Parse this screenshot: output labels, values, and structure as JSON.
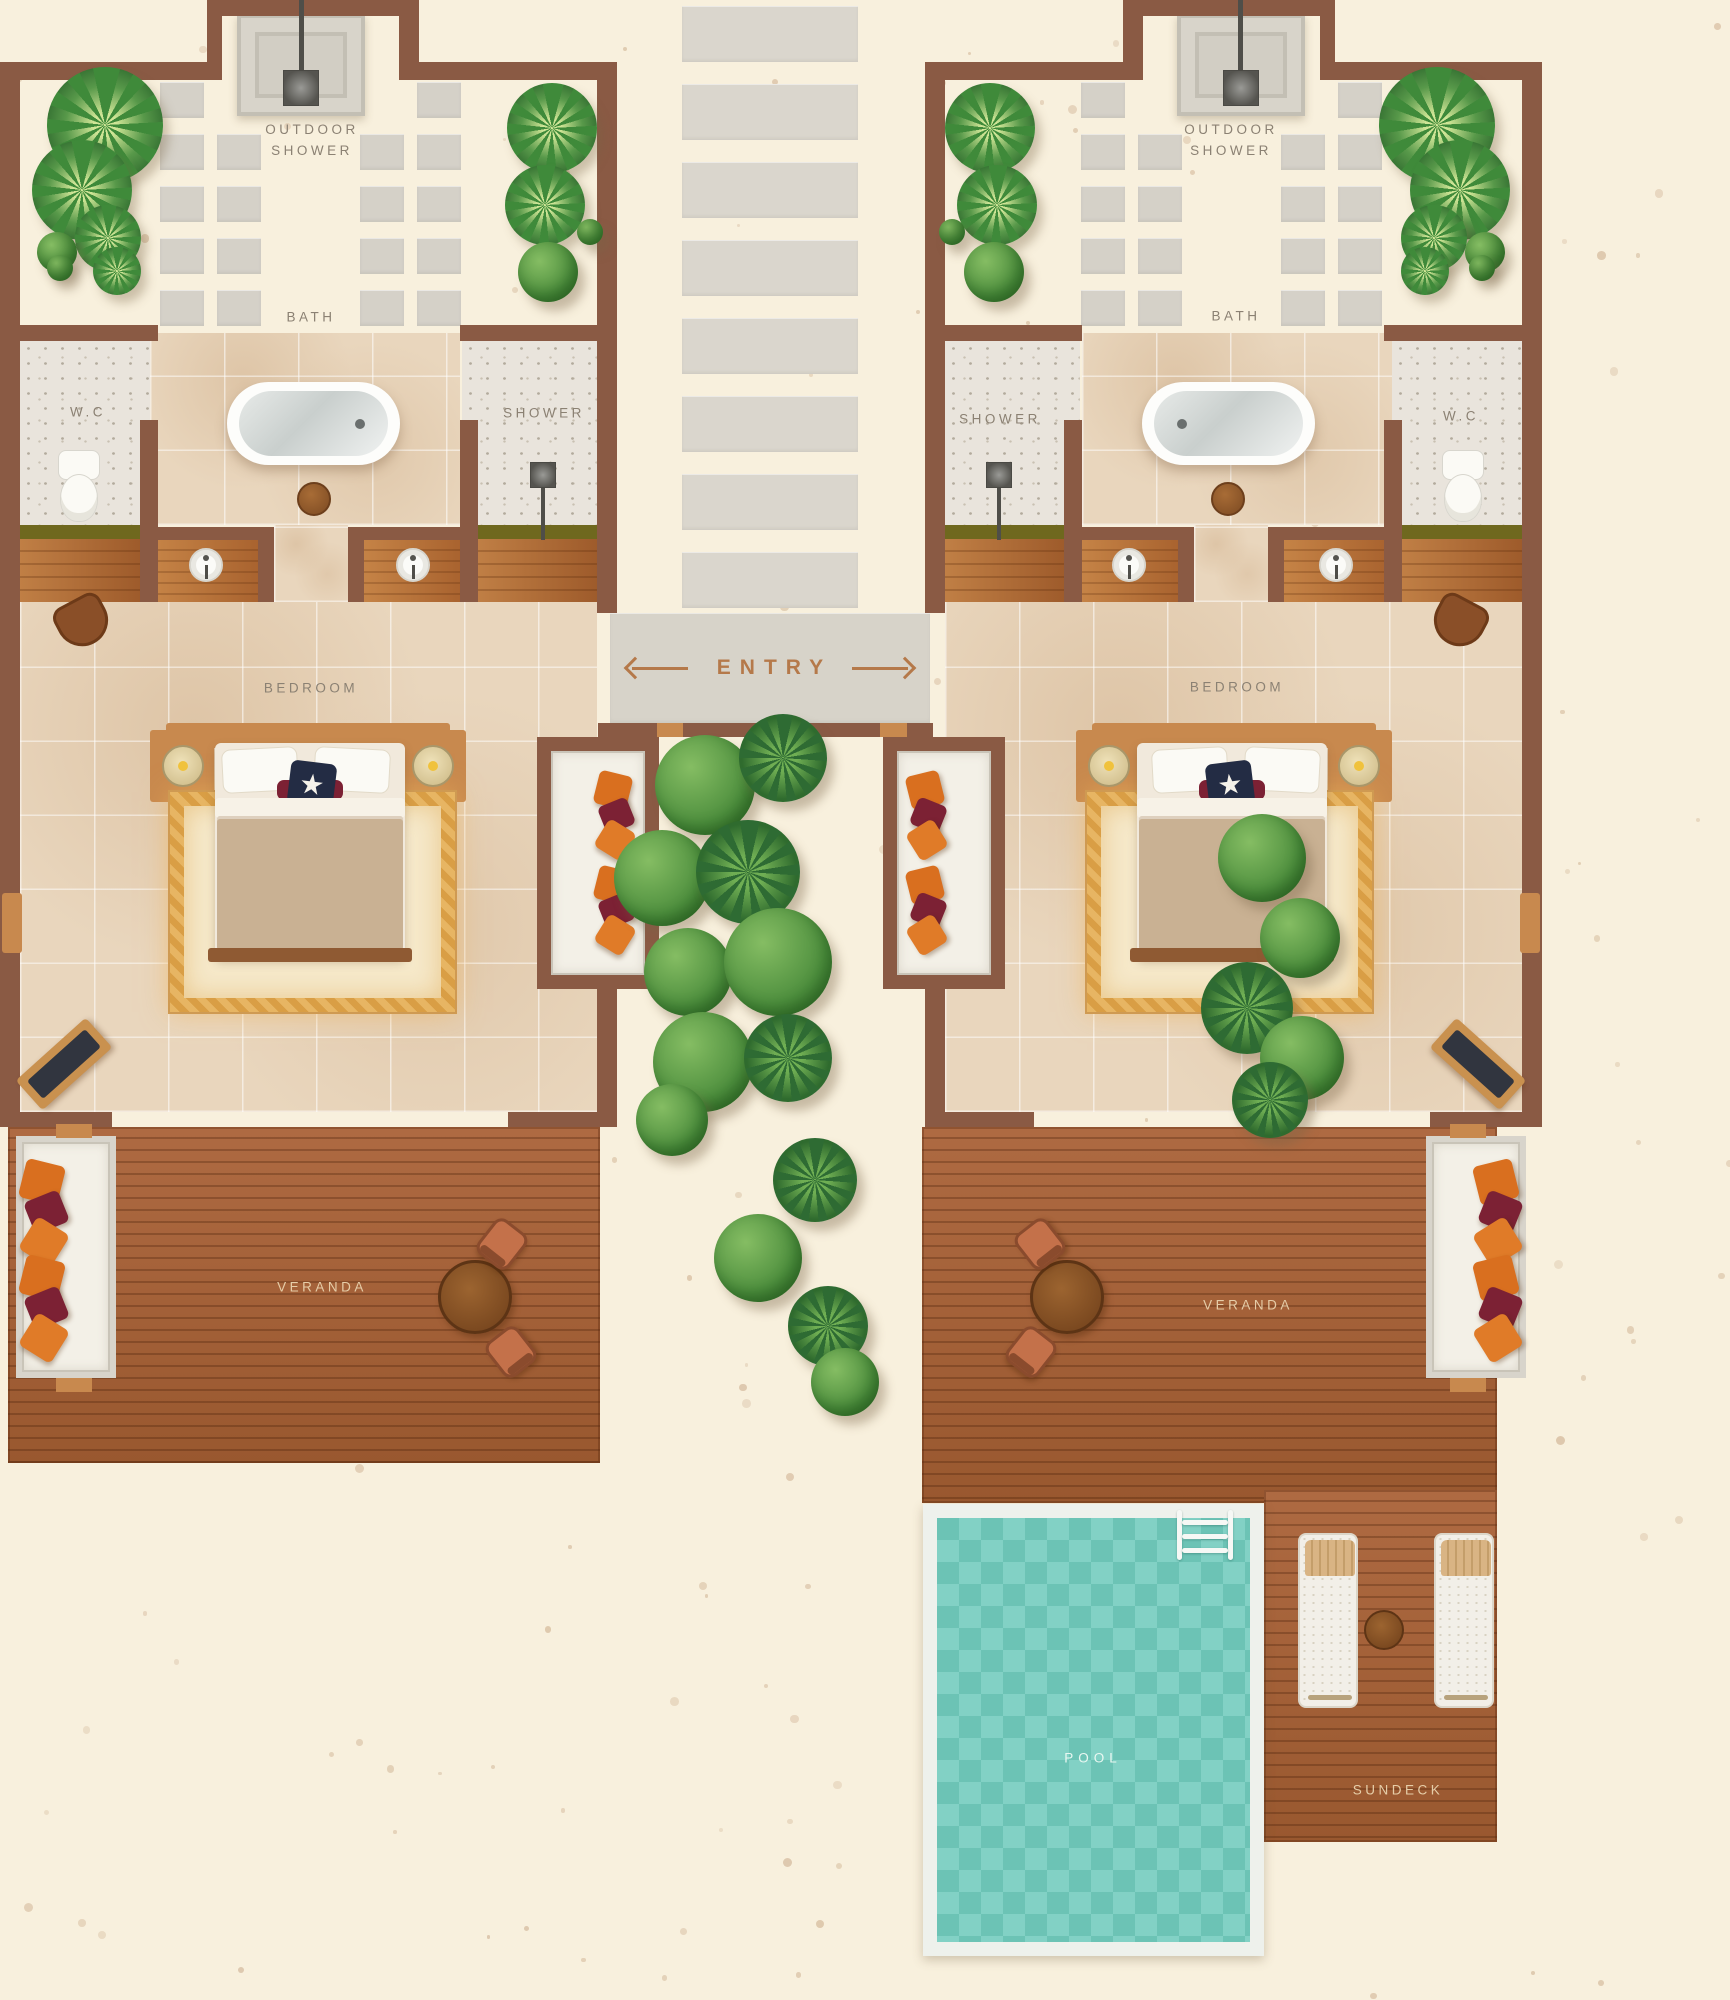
{
  "rooms": {
    "left_unit": {
      "outdoor_shower": "OUTDOOR\nSHOWER",
      "bath": "BATH",
      "wc": "W.C",
      "shower": "SHOWER",
      "bedroom": "BEDROOM",
      "veranda": "VERANDA"
    },
    "right_unit": {
      "outdoor_shower": "OUTDOOR\nSHOWER",
      "bath": "BATH",
      "wc": "W.C",
      "shower": "SHOWER",
      "bedroom": "BEDROOM",
      "veranda": "VERANDA"
    },
    "entry": "ENTRY",
    "pool": "POOL",
    "sundeck": "SUNDECK"
  },
  "colors": {
    "sand": "#f8f0dd",
    "wall": "#8a5a44",
    "deck_wood": "#a5613a",
    "marble": "#e9d6bd",
    "stone_tile": "#d5d1c8",
    "pool_water": "#74ccbe",
    "room_label": "#8b8173",
    "entry_label": "#b5794a",
    "cushion_orange": "#d96f1f",
    "cushion_maroon": "#7c2134",
    "foliage": "#4e8f3e"
  }
}
